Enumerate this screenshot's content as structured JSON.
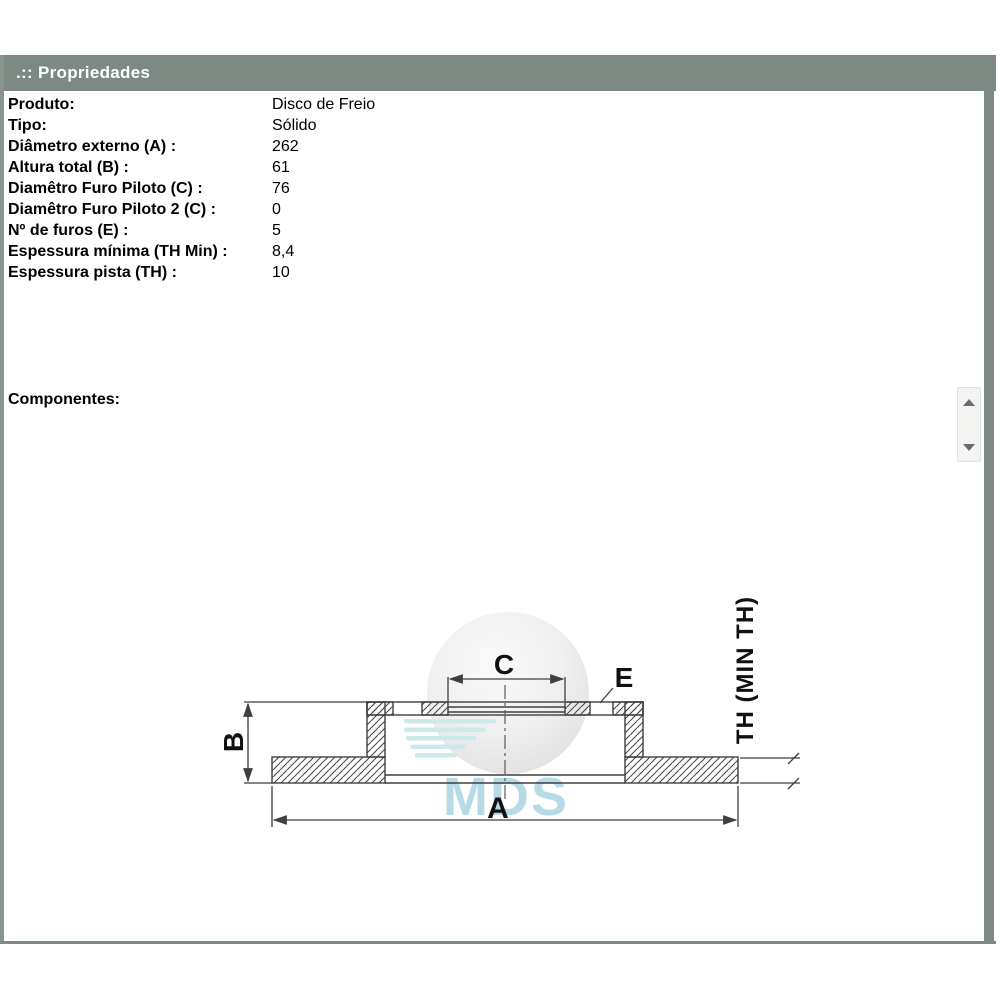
{
  "window": {
    "title": ".:: Propriedades"
  },
  "properties": {
    "rows": [
      {
        "label": "Produto:",
        "value": "Disco de Freio"
      },
      {
        "label": "Tipo:",
        "value": "Sólido"
      },
      {
        "label": "Diâmetro externo (A) :",
        "value": "262"
      },
      {
        "label": "Altura total (B) :",
        "value": "61"
      },
      {
        "label": "Diamêtro Furo Piloto (C) :",
        "value": "76"
      },
      {
        "label": "Diamêtro Furo Piloto 2 (C) :",
        "value": "0"
      },
      {
        "label": "Nº de furos (E) :",
        "value": "5"
      },
      {
        "label": "Espessura mínima (TH Min) :",
        "value": "8,4"
      },
      {
        "label": "Espessura pista (TH) :",
        "value": "10"
      }
    ]
  },
  "components": {
    "label": "Componentes:"
  },
  "drawing": {
    "labels": {
      "a": "A",
      "b": "B",
      "c": "C",
      "e": "E",
      "th": "TH (MIN TH)"
    },
    "watermark": "MDS"
  },
  "colors": {
    "frame": "#7d8a84",
    "titlebar_text": "#ffffff",
    "drawing_line": "#3f3f3f",
    "hatch": "#4a4a4a",
    "watermark_text": "#b7dbe6",
    "watermark_stripe": "#cdeaea",
    "scroll_arrow": "#6b6b6b"
  }
}
